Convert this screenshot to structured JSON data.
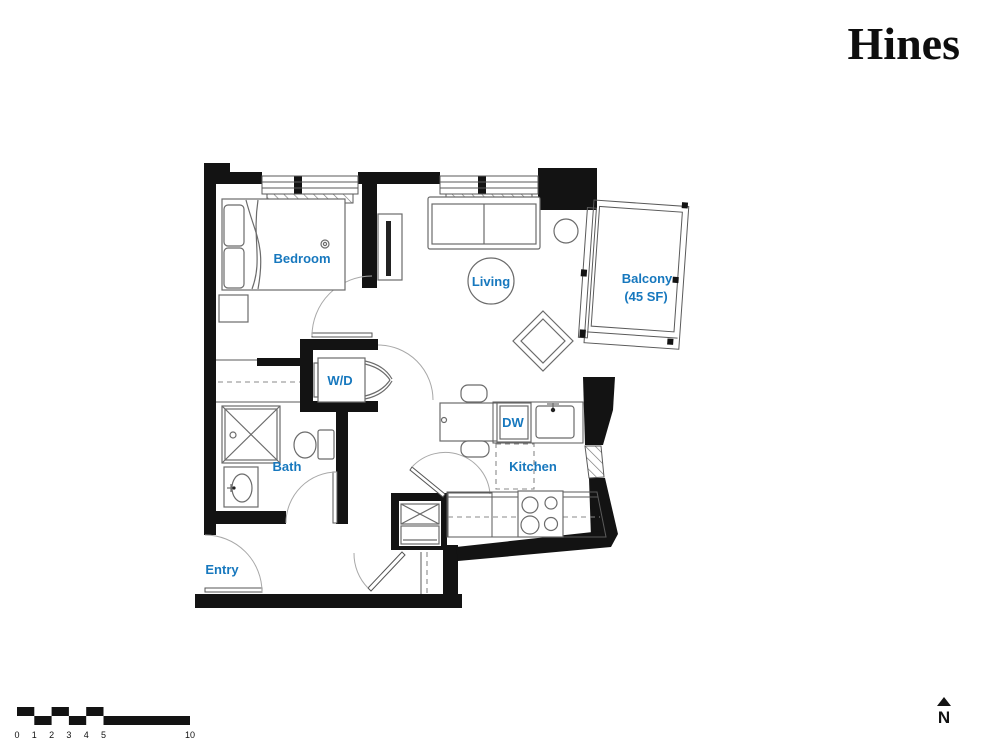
{
  "brand": {
    "logo": "Hines"
  },
  "floorplan": {
    "label_color": "#1778BE",
    "wall_color": "#131313",
    "rooms": {
      "bedroom": "Bedroom",
      "living": "Living",
      "balcony_line1": "Balcony",
      "balcony_line2": "(45 SF)",
      "washer_dryer": "W/D",
      "dishwasher": "DW",
      "bath": "Bath",
      "kitchen": "Kitchen",
      "entry": "Entry"
    }
  },
  "scalebar": {
    "ticks": [
      "0",
      "1",
      "2",
      "3",
      "4",
      "5",
      "10"
    ]
  },
  "compass": {
    "north_label": "N"
  }
}
